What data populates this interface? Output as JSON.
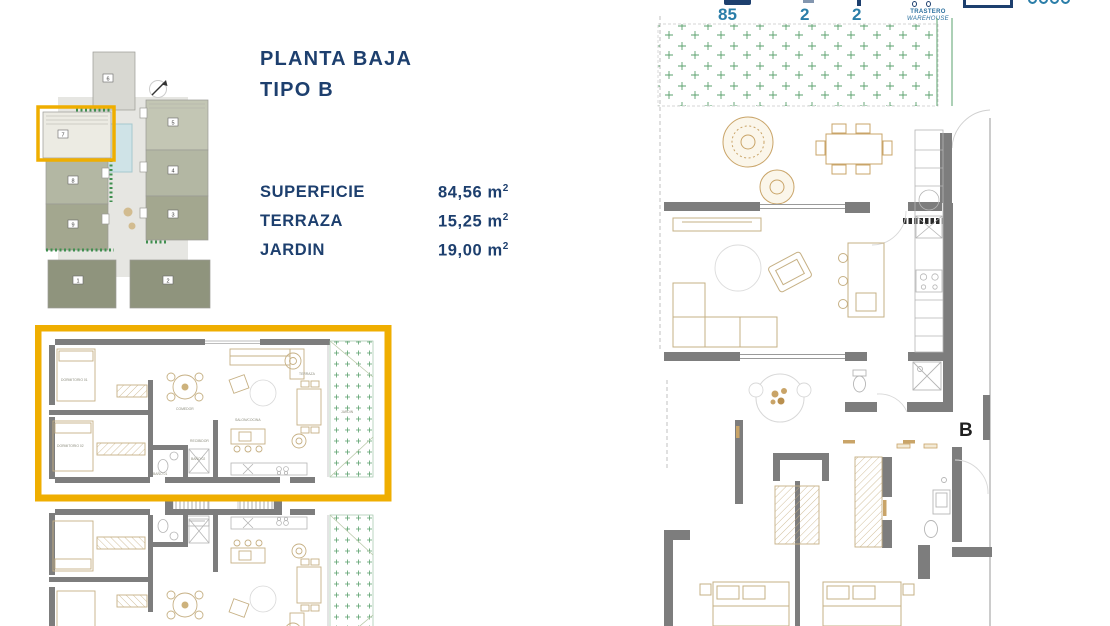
{
  "title": {
    "line1": "PLANTA BAJA",
    "line2": "TIPO B"
  },
  "specs": [
    {
      "label": "SUPERFICIE",
      "value": "84,56",
      "unit": "m",
      "sup": "2"
    },
    {
      "label": "TERRAZA",
      "value": "15,25",
      "unit": "m",
      "sup": "2"
    },
    {
      "label": "JARDIN",
      "value": "19,00",
      "unit": "m",
      "sup": "2"
    }
  ],
  "stats": {
    "surface": "85",
    "bedrooms": "2",
    "bathrooms": "2",
    "storage_label": "TRASTERO",
    "storage_label_en": "WAREHOUSE"
  },
  "site_plan": {
    "buildings": [
      "1",
      "2",
      "3",
      "4",
      "5",
      "6",
      "7",
      "8",
      "9"
    ],
    "highlighted_building": "7"
  },
  "floor_plan": {
    "unit_letter": "B"
  },
  "room_labels": {
    "bedroom1": "DORMITORIO 01",
    "bedroom2": "DORMITORIO 02",
    "bath1": "BAÑO 01",
    "bath2": "BAÑO 02",
    "hall": "RECIBIDOR",
    "dining": "COMEDOR",
    "living": "SALON/COCINA",
    "terrace": "TERRAZA",
    "garden": "JARDIN"
  },
  "colors": {
    "navy": "#1d3f6e",
    "teal": "#2a7da8",
    "accent_orange": "#efae00",
    "wall_gray": "#7d7d7d",
    "furniture_tan": "#c6b084",
    "garden_green": "#5aa06c",
    "site_olive": "#a3a78f",
    "pool_blue": "#cfe3e7"
  }
}
